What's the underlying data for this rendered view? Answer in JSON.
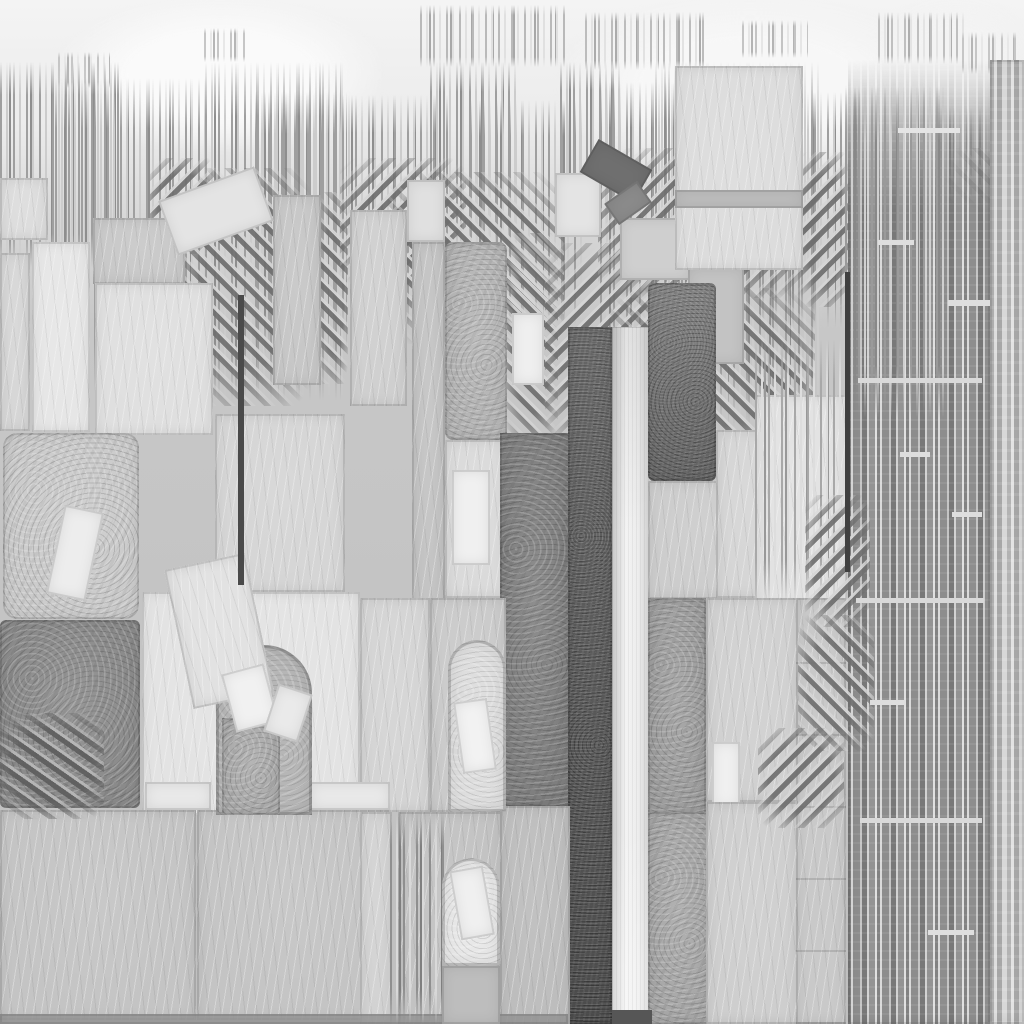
{
  "image": {
    "width": 1024,
    "height": 1024,
    "kind": "grayscale-stone-texture-collage"
  },
  "palette": {
    "sky": "#f4f4f4",
    "base": "#c6c6c6",
    "light": "#e3e3e3",
    "slab": "#c4c4c4",
    "mid": "#a7a7a7",
    "dark": "#8a8a8a",
    "darker": "#747474",
    "bar_dark": "#595959",
    "bar_light": "#f3f3f3",
    "ink": "#3f3f3f"
  },
  "defaults": {
    "strokes": {
      "a": "#9f9f9f",
      "b": "#cccccc",
      "c": "#8e8e8e"
    },
    "hatch": {
      "ang": 45,
      "d": "#6f6f6f",
      "l": "#d6d6d6"
    }
  },
  "layers": [
    {
      "k": "glow",
      "n": "sky-glow-1",
      "x": 60,
      "y": 0,
      "w": 320,
      "h": 150,
      "f": "#fafafa"
    },
    {
      "k": "glow",
      "n": "sky-glow-2",
      "x": 560,
      "y": 0,
      "w": 380,
      "h": 170,
      "f": "#f7f7f7"
    },
    {
      "k": "glow",
      "n": "sky-glow-3",
      "x": 880,
      "y": 0,
      "w": 150,
      "h": 120,
      "f": "#f3f3f3"
    },
    {
      "k": "strokes",
      "n": "drip-cluster-1",
      "x": 420,
      "y": 5,
      "w": 146,
      "h": 62,
      "a": "#b9b9b9",
      "b": "#e0e0e0",
      "c": "#a8a8a8"
    },
    {
      "k": "strokes",
      "n": "drip-cluster-2",
      "x": 585,
      "y": 12,
      "w": 122,
      "h": 58,
      "a": "#bcbcbc",
      "b": "#e2e2e2",
      "c": "#ababab"
    },
    {
      "k": "strokes",
      "n": "drip-cluster-3",
      "x": 742,
      "y": 20,
      "w": 66,
      "h": 38,
      "a": "#c4c4c4",
      "b": "#e6e6e6",
      "c": "#b4b4b4"
    },
    {
      "k": "strokes",
      "n": "drip-cluster-4",
      "x": 878,
      "y": 12,
      "w": 88,
      "h": 52,
      "a": "#bfbfbf",
      "b": "#e4e4e4",
      "c": "#aeaeae"
    },
    {
      "k": "strokes",
      "n": "drip-cluster-5",
      "x": 204,
      "y": 28,
      "w": 44,
      "h": 34,
      "a": "#c6c6c6",
      "b": "#e8e8e8",
      "c": "#b6b6b6"
    },
    {
      "k": "strokes",
      "n": "drip-cluster-6",
      "x": 58,
      "y": 52,
      "w": 52,
      "h": 36,
      "a": "#c6c6c6",
      "b": "#e8e8e8",
      "c": "#b6b6b6"
    },
    {
      "k": "strokes",
      "n": "drip-cluster-7",
      "x": 962,
      "y": 32,
      "w": 56,
      "h": 42,
      "a": "#c6c6c6",
      "b": "#e8e8e8",
      "c": "#b6b6b6"
    },
    {
      "k": "strokes",
      "n": "skyline-1",
      "x": 0,
      "y": 62,
      "w": 122,
      "h": 205
    },
    {
      "k": "strokes",
      "n": "skyline-2",
      "x": 55,
      "y": 78,
      "w": 162,
      "h": 315
    },
    {
      "k": "strokes",
      "n": "skyline-3",
      "x": 205,
      "y": 62,
      "w": 138,
      "h": 338
    },
    {
      "k": "strokes",
      "n": "skyline-4",
      "x": 255,
      "y": 92,
      "w": 92,
      "h": 262
    },
    {
      "k": "strokes",
      "n": "skyline-5",
      "x": 342,
      "y": 95,
      "w": 106,
      "h": 235
    },
    {
      "k": "strokes",
      "n": "skyline-6",
      "x": 430,
      "y": 62,
      "w": 88,
      "h": 185
    },
    {
      "k": "strokes",
      "n": "skyline-7",
      "x": 470,
      "y": 100,
      "w": 112,
      "h": 225
    },
    {
      "k": "strokes",
      "n": "skyline-8",
      "x": 560,
      "y": 62,
      "w": 62,
      "h": 175
    },
    {
      "k": "strokes",
      "n": "skyline-9",
      "x": 600,
      "y": 82,
      "w": 122,
      "h": 285
    },
    {
      "k": "strokes",
      "n": "skyline-10",
      "x": 655,
      "y": 62,
      "w": 168,
      "h": 365
    },
    {
      "k": "strokes",
      "n": "skyline-11",
      "x": 762,
      "y": 92,
      "w": 100,
      "h": 235
    },
    {
      "k": "strokes",
      "n": "skyline-12",
      "x": 845,
      "y": 85,
      "w": 104,
      "h": 410
    },
    {
      "k": "strokes",
      "n": "skyline-13",
      "x": 940,
      "y": 108,
      "w": 84,
      "h": 205
    },
    {
      "k": "hatch",
      "n": "hatch-1",
      "x": 150,
      "y": 158,
      "w": 66,
      "h": 96,
      "ang": -45
    },
    {
      "k": "hatch",
      "n": "hatch-2",
      "x": 185,
      "y": 168,
      "w": 126,
      "h": 238,
      "ang": 45
    },
    {
      "k": "hatch",
      "n": "hatch-2b",
      "x": 318,
      "y": 192,
      "w": 30,
      "h": 192,
      "ang": 45
    },
    {
      "k": "hatch",
      "n": "hatch-3",
      "x": 340,
      "y": 158,
      "w": 126,
      "h": 128,
      "ang": -45
    },
    {
      "k": "hatch",
      "n": "hatch-4",
      "x": 388,
      "y": 172,
      "w": 176,
      "h": 172,
      "ang": 45
    },
    {
      "k": "hatch",
      "n": "hatch-5",
      "x": 506,
      "y": 233,
      "w": 52,
      "h": 214,
      "ang": 45
    },
    {
      "k": "hatch",
      "n": "hatch-6",
      "x": 545,
      "y": 243,
      "w": 120,
      "h": 205,
      "ang": -45
    },
    {
      "k": "hatch",
      "n": "hatch-7",
      "x": 598,
      "y": 148,
      "w": 222,
      "h": 150,
      "ang": -45
    },
    {
      "k": "hatch",
      "n": "hatch-8",
      "x": 610,
      "y": 288,
      "w": 205,
      "h": 165,
      "ang": 45
    },
    {
      "k": "hatch",
      "n": "hatch-9",
      "x": 800,
      "y": 152,
      "w": 50,
      "h": 155,
      "ang": -45
    },
    {
      "k": "hatch",
      "n": "hatch-10",
      "x": 945,
      "y": 148,
      "w": 79,
      "h": 270,
      "ang": 45
    },
    {
      "k": "block",
      "n": "left-edge-block-a",
      "x": 0,
      "y": 178,
      "w": 48,
      "h": 62,
      "f": "#dcdcdc",
      "t": "scratch"
    },
    {
      "k": "block",
      "n": "left-edge-block-b",
      "x": 0,
      "y": 253,
      "w": 30,
      "h": 178,
      "f": "#d6d6d6",
      "t": "scratch"
    },
    {
      "k": "block",
      "n": "light-column",
      "x": 32,
      "y": 242,
      "w": 58,
      "h": 190,
      "f": "#e6e6e6",
      "t": "scratch"
    },
    {
      "k": "block",
      "n": "upper-block-a",
      "x": 93,
      "y": 218,
      "w": 92,
      "h": 66,
      "f": "#c8c8c8",
      "t": "scratch"
    },
    {
      "k": "block",
      "n": "upper-block-b",
      "x": 95,
      "y": 283,
      "w": 118,
      "h": 152,
      "f": "#dfdfdf",
      "t": "scratch"
    },
    {
      "k": "block",
      "n": "stack-column",
      "x": 273,
      "y": 195,
      "w": 48,
      "h": 190,
      "f": "#c6c6c6",
      "t": "scratch"
    },
    {
      "k": "block",
      "n": "mid-panel",
      "x": 215,
      "y": 414,
      "w": 130,
      "h": 178,
      "f": "#d5d5d5",
      "t": "scratch"
    },
    {
      "k": "block",
      "n": "center-column",
      "x": 350,
      "y": 210,
      "w": 57,
      "h": 196,
      "f": "#cfcfcf",
      "t": "scratch"
    },
    {
      "k": "block",
      "n": "center-small",
      "x": 407,
      "y": 180,
      "w": 38,
      "h": 62,
      "f": "#e0e0e0",
      "t": "plain"
    },
    {
      "k": "block",
      "n": "center-strip",
      "x": 412,
      "y": 242,
      "w": 33,
      "h": 400,
      "f": "#c3c3c3",
      "t": "scratch"
    },
    {
      "k": "block",
      "n": "center-big-block",
      "x": 445,
      "y": 242,
      "w": 62,
      "h": 198,
      "f": "#b4b4b4",
      "t": "mottle",
      "r": 8
    },
    {
      "k": "block",
      "n": "hatch-window",
      "x": 512,
      "y": 313,
      "w": 32,
      "h": 72,
      "f": "#efefef",
      "t": "plain"
    },
    {
      "k": "block",
      "n": "center-under",
      "x": 445,
      "y": 440,
      "w": 61,
      "h": 158,
      "f": "#dadada",
      "t": "scratch"
    },
    {
      "k": "block",
      "n": "center-under-white",
      "x": 452,
      "y": 470,
      "w": 38,
      "h": 95,
      "f": "#f0f0f0",
      "t": "plain"
    },
    {
      "k": "block",
      "n": "center-top-light",
      "x": 555,
      "y": 173,
      "w": 46,
      "h": 64,
      "f": "#e4e4e4",
      "t": "plain"
    },
    {
      "k": "block",
      "n": "top-small-1",
      "x": 620,
      "y": 218,
      "w": 70,
      "h": 62,
      "f": "#cfcfcf",
      "t": "plain"
    },
    {
      "k": "block",
      "n": "top-small-2",
      "x": 688,
      "y": 268,
      "w": 56,
      "h": 96,
      "f": "#c3c3c3",
      "t": "plain"
    },
    {
      "k": "block",
      "n": "right-top-light",
      "x": 675,
      "y": 66,
      "w": 128,
      "h": 204,
      "f": "#dcdcdc",
      "t": "scratch"
    },
    {
      "k": "block",
      "n": "right-top-band",
      "x": 675,
      "y": 190,
      "w": 128,
      "h": 18,
      "f": "#bdbdbd",
      "t": "plain"
    },
    {
      "k": "block",
      "n": "rounded-light-block",
      "x": 3,
      "y": 433,
      "w": 136,
      "h": 186,
      "f": "#cbcbcb",
      "t": "mottle",
      "r": 14
    },
    {
      "k": "block",
      "n": "dark-mottled-block",
      "x": 0,
      "y": 620,
      "w": 140,
      "h": 188,
      "f": "#8a8a8a",
      "t": "mottle",
      "r": 6
    },
    {
      "k": "block",
      "n": "arch-wall-left",
      "x": 142,
      "y": 592,
      "w": 218,
      "h": 223,
      "f": "#e3e3e3",
      "t": "scratch"
    },
    {
      "k": "block",
      "n": "mid-dark-column",
      "x": 500,
      "y": 433,
      "w": 70,
      "h": 374,
      "f": "#7e7e7e",
      "t": "mottle"
    },
    {
      "k": "block",
      "n": "wall2-left",
      "x": 360,
      "y": 598,
      "w": 70,
      "h": 214,
      "f": "#d4d4d4",
      "t": "scratch"
    },
    {
      "k": "block",
      "n": "wall2",
      "x": 430,
      "y": 598,
      "w": 76,
      "h": 214,
      "f": "#cacaca",
      "t": "scratch"
    },
    {
      "k": "block",
      "n": "dark-bar",
      "x": 568,
      "y": 327,
      "w": 44,
      "h": 697,
      "f": "#595959",
      "t": "grain"
    },
    {
      "k": "block",
      "n": "light-gradient-bar",
      "x": 612,
      "y": 327,
      "w": 40,
      "h": 697,
      "t": "grad"
    },
    {
      "k": "block",
      "n": "dark-rect",
      "x": 648,
      "y": 283,
      "w": 68,
      "h": 198,
      "f": "#747474",
      "t": "grain",
      "r": 6
    },
    {
      "k": "block",
      "n": "under-dark-rect",
      "x": 648,
      "y": 481,
      "w": 110,
      "h": 118,
      "f": "#cccccc",
      "t": "scratch"
    },
    {
      "k": "block",
      "n": "grain-strip-a",
      "x": 648,
      "y": 598,
      "w": 58,
      "h": 216,
      "f": "#9e9e9e",
      "t": "mottle"
    },
    {
      "k": "block",
      "n": "grain-strip-b",
      "x": 648,
      "y": 812,
      "w": 62,
      "h": 212,
      "f": "#a7a7a7",
      "t": "mottle"
    },
    {
      "k": "block",
      "n": "right-mid-block",
      "x": 716,
      "y": 430,
      "w": 62,
      "h": 168,
      "f": "#d5d5d5",
      "t": "scratch"
    },
    {
      "k": "block",
      "n": "right-light-block",
      "x": 755,
      "y": 395,
      "w": 92,
      "h": 212,
      "f": "#e2e2e2",
      "t": "scratch"
    },
    {
      "k": "block",
      "n": "right-col-a",
      "x": 706,
      "y": 598,
      "w": 92,
      "h": 204,
      "f": "#d0d0d0",
      "t": "scratch"
    },
    {
      "k": "block",
      "n": "right-col-window",
      "x": 712,
      "y": 742,
      "w": 28,
      "h": 66,
      "f": "#f0f0f0",
      "t": "plain"
    },
    {
      "k": "block",
      "n": "right-col-b",
      "x": 706,
      "y": 802,
      "w": 92,
      "h": 222,
      "f": "#cecece",
      "t": "scratch"
    },
    {
      "k": "block",
      "n": "right-col-ruled",
      "x": 796,
      "y": 598,
      "w": 50,
      "h": 426,
      "f": "#c9c9c9",
      "t": "scratch-rules"
    },
    {
      "k": "block",
      "n": "bottom-slab-a",
      "x": 0,
      "y": 810,
      "w": 196,
      "h": 210,
      "f": "#c4c4c4",
      "t": "scratch"
    },
    {
      "k": "block",
      "n": "bottom-slab-b",
      "x": 197,
      "y": 810,
      "w": 192,
      "h": 210,
      "f": "#c4c4c4",
      "t": "scratch"
    },
    {
      "k": "block",
      "n": "small-light-a",
      "x": 145,
      "y": 782,
      "w": 66,
      "h": 28,
      "f": "#e9e9e9",
      "t": "plain"
    },
    {
      "k": "block",
      "n": "small-light-b",
      "x": 310,
      "y": 782,
      "w": 80,
      "h": 28,
      "f": "#e9e9e9",
      "t": "plain"
    },
    {
      "k": "block",
      "n": "bottom-left-strip",
      "x": 360,
      "y": 812,
      "w": 32,
      "h": 212,
      "f": "#d2d2d2",
      "t": "scratch"
    },
    {
      "k": "block",
      "n": "bottom-wall",
      "x": 398,
      "y": 812,
      "w": 104,
      "h": 212,
      "f": "#c2c2c2",
      "t": "scratch"
    },
    {
      "k": "block",
      "n": "bottom-block",
      "x": 500,
      "y": 806,
      "w": 70,
      "h": 218,
      "f": "#bdbdbd",
      "t": "scratch"
    },
    {
      "k": "block",
      "n": "bottom-mortar-band",
      "x": 0,
      "y": 1014,
      "w": 568,
      "h": 10,
      "f": "#9c9c9c",
      "t": "plain",
      "o": 0.85
    },
    {
      "k": "block",
      "n": "barcode-field",
      "x": 848,
      "y": 60,
      "w": 142,
      "h": 964,
      "t": "barcode bc-fade"
    },
    {
      "k": "block",
      "n": "barcode-field-light",
      "x": 990,
      "y": 60,
      "w": 34,
      "h": 964,
      "t": "barcode2"
    },
    {
      "k": "strokes",
      "n": "bottom-stroke-cluster",
      "x": 390,
      "y": 812,
      "w": 54,
      "h": 212,
      "a": "#8f8f8f",
      "b": "#d9d9d9",
      "c": "#7f7f7f"
    },
    {
      "k": "strokes",
      "n": "right-stroke-cluster",
      "x": 755,
      "y": 340,
      "w": 92,
      "h": 262,
      "a": "#a8a8a8",
      "b": "#dddddd",
      "c": "#989898"
    },
    {
      "k": "strokes",
      "n": "tower-strokes",
      "x": 845,
      "y": 88,
      "w": 102,
      "h": 330,
      "a": "#9a9a9a",
      "b": "#d0d0d0",
      "c": "#888888"
    },
    {
      "k": "hatch",
      "n": "hatch-front-1",
      "x": 805,
      "y": 495,
      "w": 65,
      "h": 132,
      "ang": -45
    },
    {
      "k": "hatch",
      "n": "hatch-front-2",
      "x": 798,
      "y": 615,
      "w": 76,
      "h": 136,
      "ang": 45
    },
    {
      "k": "hatch",
      "n": "hatch-front-3",
      "x": 758,
      "y": 728,
      "w": 86,
      "h": 100,
      "ang": -45
    },
    {
      "k": "hatch",
      "n": "hatch-front-4",
      "x": 282,
      "y": 730,
      "w": 30,
      "h": 84,
      "ang": 45
    },
    {
      "k": "hatch",
      "n": "hatch-front-5",
      "x": 0,
      "y": 713,
      "w": 104,
      "h": 106,
      "ang": 35,
      "d": "#5e5e5e",
      "l": "#b9b9b9"
    },
    {
      "k": "arch",
      "n": "arch-1",
      "x": 216,
      "y": 645,
      "w": 96,
      "h": 170,
      "f": "#b6b6b6",
      "r": 48
    },
    {
      "k": "block",
      "n": "arch-1-pier",
      "x": 222,
      "y": 718,
      "w": 58,
      "h": 97,
      "f": "#ababab",
      "t": "mottle"
    },
    {
      "k": "arch",
      "n": "arch-2",
      "x": 448,
      "y": 640,
      "w": 58,
      "h": 172,
      "f": "#dedede",
      "r": 29
    },
    {
      "k": "arch",
      "n": "arch-3",
      "x": 442,
      "y": 858,
      "w": 58,
      "h": 108,
      "f": "#e8e8e8",
      "r": 29
    },
    {
      "k": "block",
      "n": "arch-3-base",
      "x": 442,
      "y": 966,
      "w": 58,
      "h": 58,
      "f": "#bdbdbd",
      "t": "plain"
    },
    {
      "k": "block",
      "n": "tilted-slab-1",
      "x": 165,
      "y": 182,
      "w": 102,
      "h": 58,
      "f": "#e4e4e4",
      "t": "plain",
      "rot": -20
    },
    {
      "k": "block",
      "n": "tilted-slab-2",
      "x": 178,
      "y": 560,
      "w": 82,
      "h": 142,
      "f": "#e1e1e1",
      "t": "scratch",
      "rot": -12
    },
    {
      "k": "block",
      "n": "tilted-dark-1",
      "x": 585,
      "y": 152,
      "w": 62,
      "h": 38,
      "f": "#6f6f6f",
      "t": "plain",
      "rot": 30
    },
    {
      "k": "block",
      "n": "tilted-dark-2",
      "x": 608,
      "y": 190,
      "w": 40,
      "h": 26,
      "f": "#8b8b8b",
      "t": "plain",
      "rot": -35
    },
    {
      "k": "block",
      "n": "arch-1-tilt-a",
      "x": 228,
      "y": 668,
      "w": 44,
      "h": 60,
      "f": "#f1f1f1",
      "t": "plain",
      "rot": -15
    },
    {
      "k": "block",
      "n": "arch-1-tilt-b",
      "x": 270,
      "y": 688,
      "w": 36,
      "h": 50,
      "f": "#eaeaea",
      "t": "plain",
      "rot": 18
    },
    {
      "k": "block",
      "n": "arch-2-tilt",
      "x": 458,
      "y": 700,
      "w": 34,
      "h": 72,
      "f": "#f2f2f2",
      "t": "plain",
      "rot": -8
    },
    {
      "k": "block",
      "n": "arch-3-tilt",
      "x": 455,
      "y": 868,
      "w": 34,
      "h": 70,
      "f": "#f0f0f0",
      "t": "plain",
      "rot": -10
    },
    {
      "k": "block",
      "n": "left-tilt",
      "x": 55,
      "y": 508,
      "w": 40,
      "h": 90,
      "f": "#ededed",
      "t": "plain",
      "rot": 12
    },
    {
      "k": "line",
      "n": "dark-line-center",
      "x": 238,
      "y": 295,
      "w": 6,
      "h": 290,
      "f": "#4a4a4a"
    },
    {
      "k": "line",
      "n": "dark-line-right",
      "x": 845,
      "y": 272,
      "w": 5,
      "h": 300,
      "f": "#3f3f3f"
    },
    {
      "k": "line",
      "n": "bar-foot-shadow",
      "x": 612,
      "y": 1010,
      "w": 40,
      "h": 14,
      "f": "#565656"
    },
    {
      "k": "line",
      "n": "barcode-dash-1",
      "x": 858,
      "y": 378,
      "w": 124,
      "h": 5,
      "f": "#d9d9d9"
    },
    {
      "k": "line",
      "n": "barcode-dash-2",
      "x": 856,
      "y": 598,
      "w": 128,
      "h": 5,
      "f": "#d9d9d9"
    },
    {
      "k": "line",
      "n": "barcode-dash-3",
      "x": 860,
      "y": 818,
      "w": 122,
      "h": 5,
      "f": "#d9d9d9"
    },
    {
      "k": "line",
      "n": "barcode-dash-4",
      "x": 948,
      "y": 300,
      "w": 42,
      "h": 6,
      "f": "#dedede"
    },
    {
      "k": "line",
      "n": "barcode-dash-5",
      "x": 900,
      "y": 452,
      "w": 30,
      "h": 5,
      "f": "#dedede"
    },
    {
      "k": "line",
      "n": "barcode-dash-6",
      "x": 870,
      "y": 700,
      "w": 36,
      "h": 5,
      "f": "#dedede"
    },
    {
      "k": "line",
      "n": "barcode-dash-7",
      "x": 928,
      "y": 930,
      "w": 46,
      "h": 5,
      "f": "#dedede"
    },
    {
      "k": "line",
      "n": "barcode-dash-8",
      "x": 952,
      "y": 512,
      "w": 30,
      "h": 5,
      "f": "#dedede"
    },
    {
      "k": "line",
      "n": "barcode-dash-9",
      "x": 878,
      "y": 240,
      "w": 36,
      "h": 5,
      "f": "#dedede"
    },
    {
      "k": "line",
      "n": "barcode-dash-10",
      "x": 898,
      "y": 128,
      "w": 62,
      "h": 5,
      "f": "#e4e4e4"
    }
  ]
}
